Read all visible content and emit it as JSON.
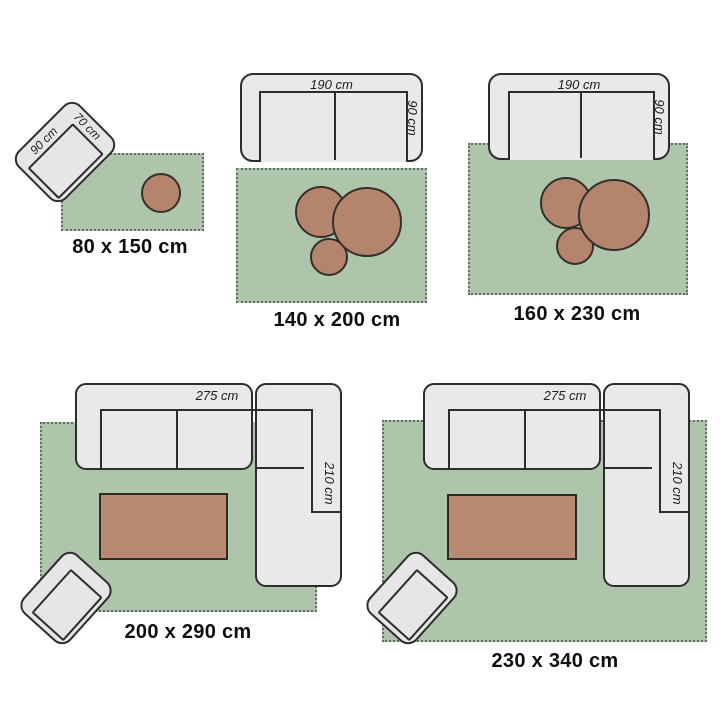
{
  "colors": {
    "rug_green": "#aec4ab",
    "rug_fringe": "#5f6e60",
    "decor_brown": "#b5846c",
    "furniture_grey": "#e9e9e9",
    "outline_dark": "#2d2d2d",
    "label_text": "#0f0f0f"
  },
  "scenes": [
    {
      "rug_label": "80 x 150 cm",
      "armchair": {
        "width_label": "90 cm",
        "depth_label": "70 cm"
      }
    },
    {
      "rug_label": "140 x 200 cm",
      "sofa": {
        "width_label": "190 cm",
        "depth_label": "90 cm"
      }
    },
    {
      "rug_label": "160 x 230 cm",
      "sofa": {
        "width_label": "190 cm",
        "depth_label": "90 cm"
      }
    },
    {
      "rug_label": "200 x 290 cm",
      "sofa": {
        "width_label": "275 cm",
        "depth_label": "210 cm"
      }
    },
    {
      "rug_label": "230 x 340 cm",
      "sofa": {
        "width_label": "275 cm",
        "depth_label": "210 cm"
      }
    }
  ]
}
